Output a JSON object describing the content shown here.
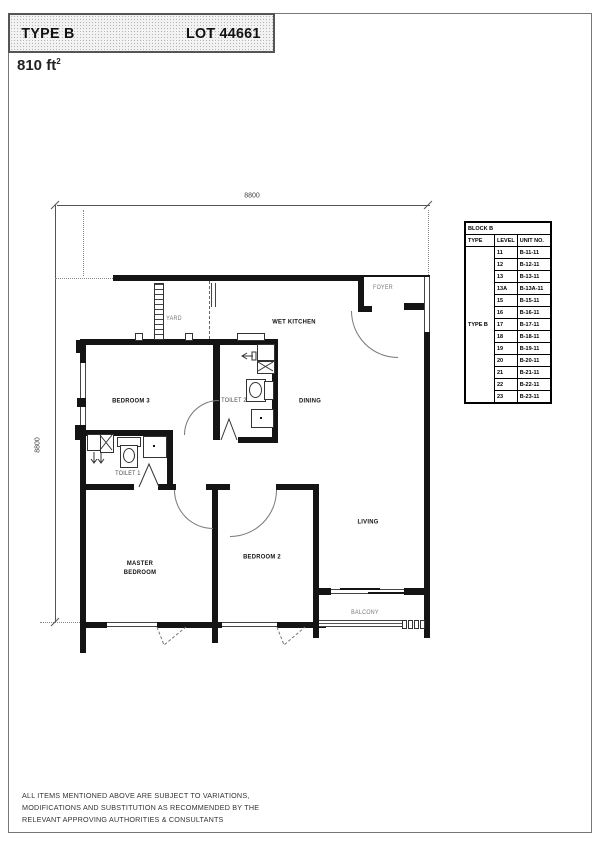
{
  "header": {
    "type": "TYPE B",
    "lot": "LOT 44661"
  },
  "area": {
    "value": "810 ft",
    "sup": "2"
  },
  "dimensions": {
    "top": "8800",
    "left": "8800"
  },
  "rooms": {
    "yard": "YARD",
    "wet_kitchen": "WET KITCHEN",
    "foyer": "FOYER",
    "bedroom3": "BEDROOM 3",
    "toilet2": "TOILET 2",
    "dining": "DINING",
    "toilet1": "TOILET 1",
    "master_bedroom": "MASTER BEDROOM",
    "bedroom2": "BEDROOM 2",
    "living": "LIVING",
    "balcony": "BALCONY"
  },
  "unit_table": {
    "title": "BLOCK B",
    "columns": [
      "TYPE",
      "LEVEL",
      "UNIT NO."
    ],
    "type_value": "TYPE B",
    "rows": [
      {
        "level": "11",
        "unit": "B-11-11"
      },
      {
        "level": "12",
        "unit": "B-12-11"
      },
      {
        "level": "13",
        "unit": "B-13-11"
      },
      {
        "level": "13A",
        "unit": "B-13A-11"
      },
      {
        "level": "15",
        "unit": "B-15-11"
      },
      {
        "level": "16",
        "unit": "B-16-11"
      },
      {
        "level": "17",
        "unit": "B-17-11"
      },
      {
        "level": "18",
        "unit": "B-18-11"
      },
      {
        "level": "19",
        "unit": "B-19-11"
      },
      {
        "level": "20",
        "unit": "B-20-11"
      },
      {
        "level": "21",
        "unit": "B-21-11"
      },
      {
        "level": "22",
        "unit": "B-22-11"
      },
      {
        "level": "23",
        "unit": "B-23-11"
      }
    ]
  },
  "footer": {
    "line1": "ALL ITEMS MENTIONED ABOVE ARE SUBJECT TO VARIATIONS,",
    "line2": "MODIFICATIONS AND SUBSTITUTION AS RECOMMENDED BY THE",
    "line3": "RELEVANT APPROVING AUTHORITIES & CONSULTANTS"
  }
}
